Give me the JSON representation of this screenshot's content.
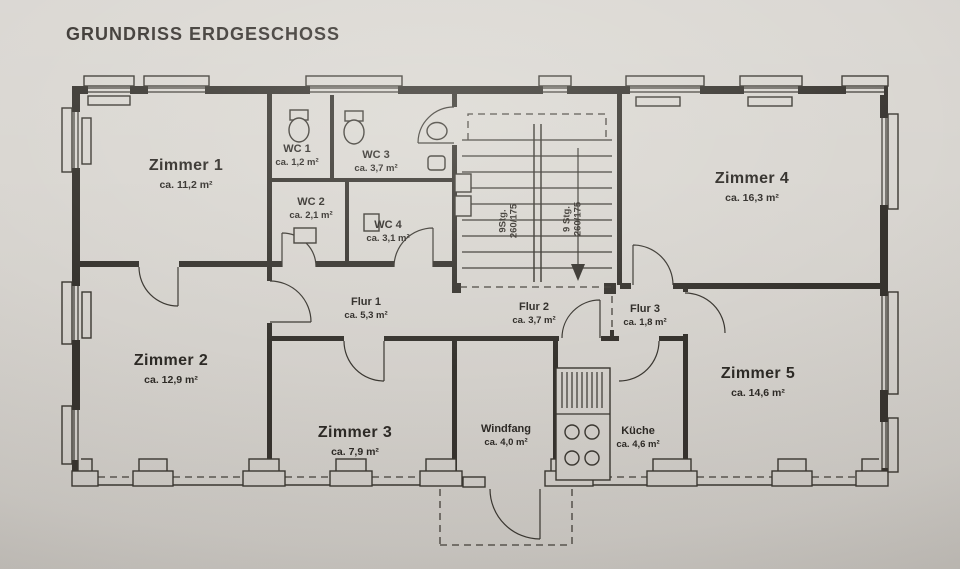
{
  "title": "GRUNDRISS ERDGESCHOSS",
  "rooms": [
    {
      "id": "zimmer1",
      "name": "Zimmer 1",
      "area": "ca. 11,2 m²"
    },
    {
      "id": "zimmer2",
      "name": "Zimmer 2",
      "area": "ca. 12,9 m²"
    },
    {
      "id": "zimmer3",
      "name": "Zimmer 3",
      "area": "ca. 7,9 m²"
    },
    {
      "id": "zimmer4",
      "name": "Zimmer 4",
      "area": "ca. 16,3 m²"
    },
    {
      "id": "zimmer5",
      "name": "Zimmer 5",
      "area": "ca. 14,6 m²"
    },
    {
      "id": "wc1",
      "name": "WC 1",
      "area": "ca. 1,2 m²"
    },
    {
      "id": "wc2",
      "name": "WC 2",
      "area": "ca. 2,1 m²"
    },
    {
      "id": "wc3",
      "name": "WC 3",
      "area": "ca. 3,7 m²"
    },
    {
      "id": "wc4",
      "name": "WC 4",
      "area": "ca. 3,1 m²"
    },
    {
      "id": "flur1",
      "name": "Flur 1",
      "area": "ca. 5,3 m²"
    },
    {
      "id": "flur2",
      "name": "Flur 2",
      "area": "ca. 3,7 m²"
    },
    {
      "id": "flur3",
      "name": "Flur 3",
      "area": "ca. 1,8 m²"
    },
    {
      "id": "windfang",
      "name": "Windfang",
      "area": "ca. 4,0 m²"
    },
    {
      "id": "kueche",
      "name": "Küche",
      "area": "ca. 4,6 m²"
    }
  ],
  "stairs": {
    "left_line1": "9Stg.",
    "left_line2": "260/175",
    "right_line1": "9 Stg.",
    "right_line2": "260/175"
  },
  "colors": {
    "paper": "#d9d6d1",
    "ink": "#36332e"
  }
}
